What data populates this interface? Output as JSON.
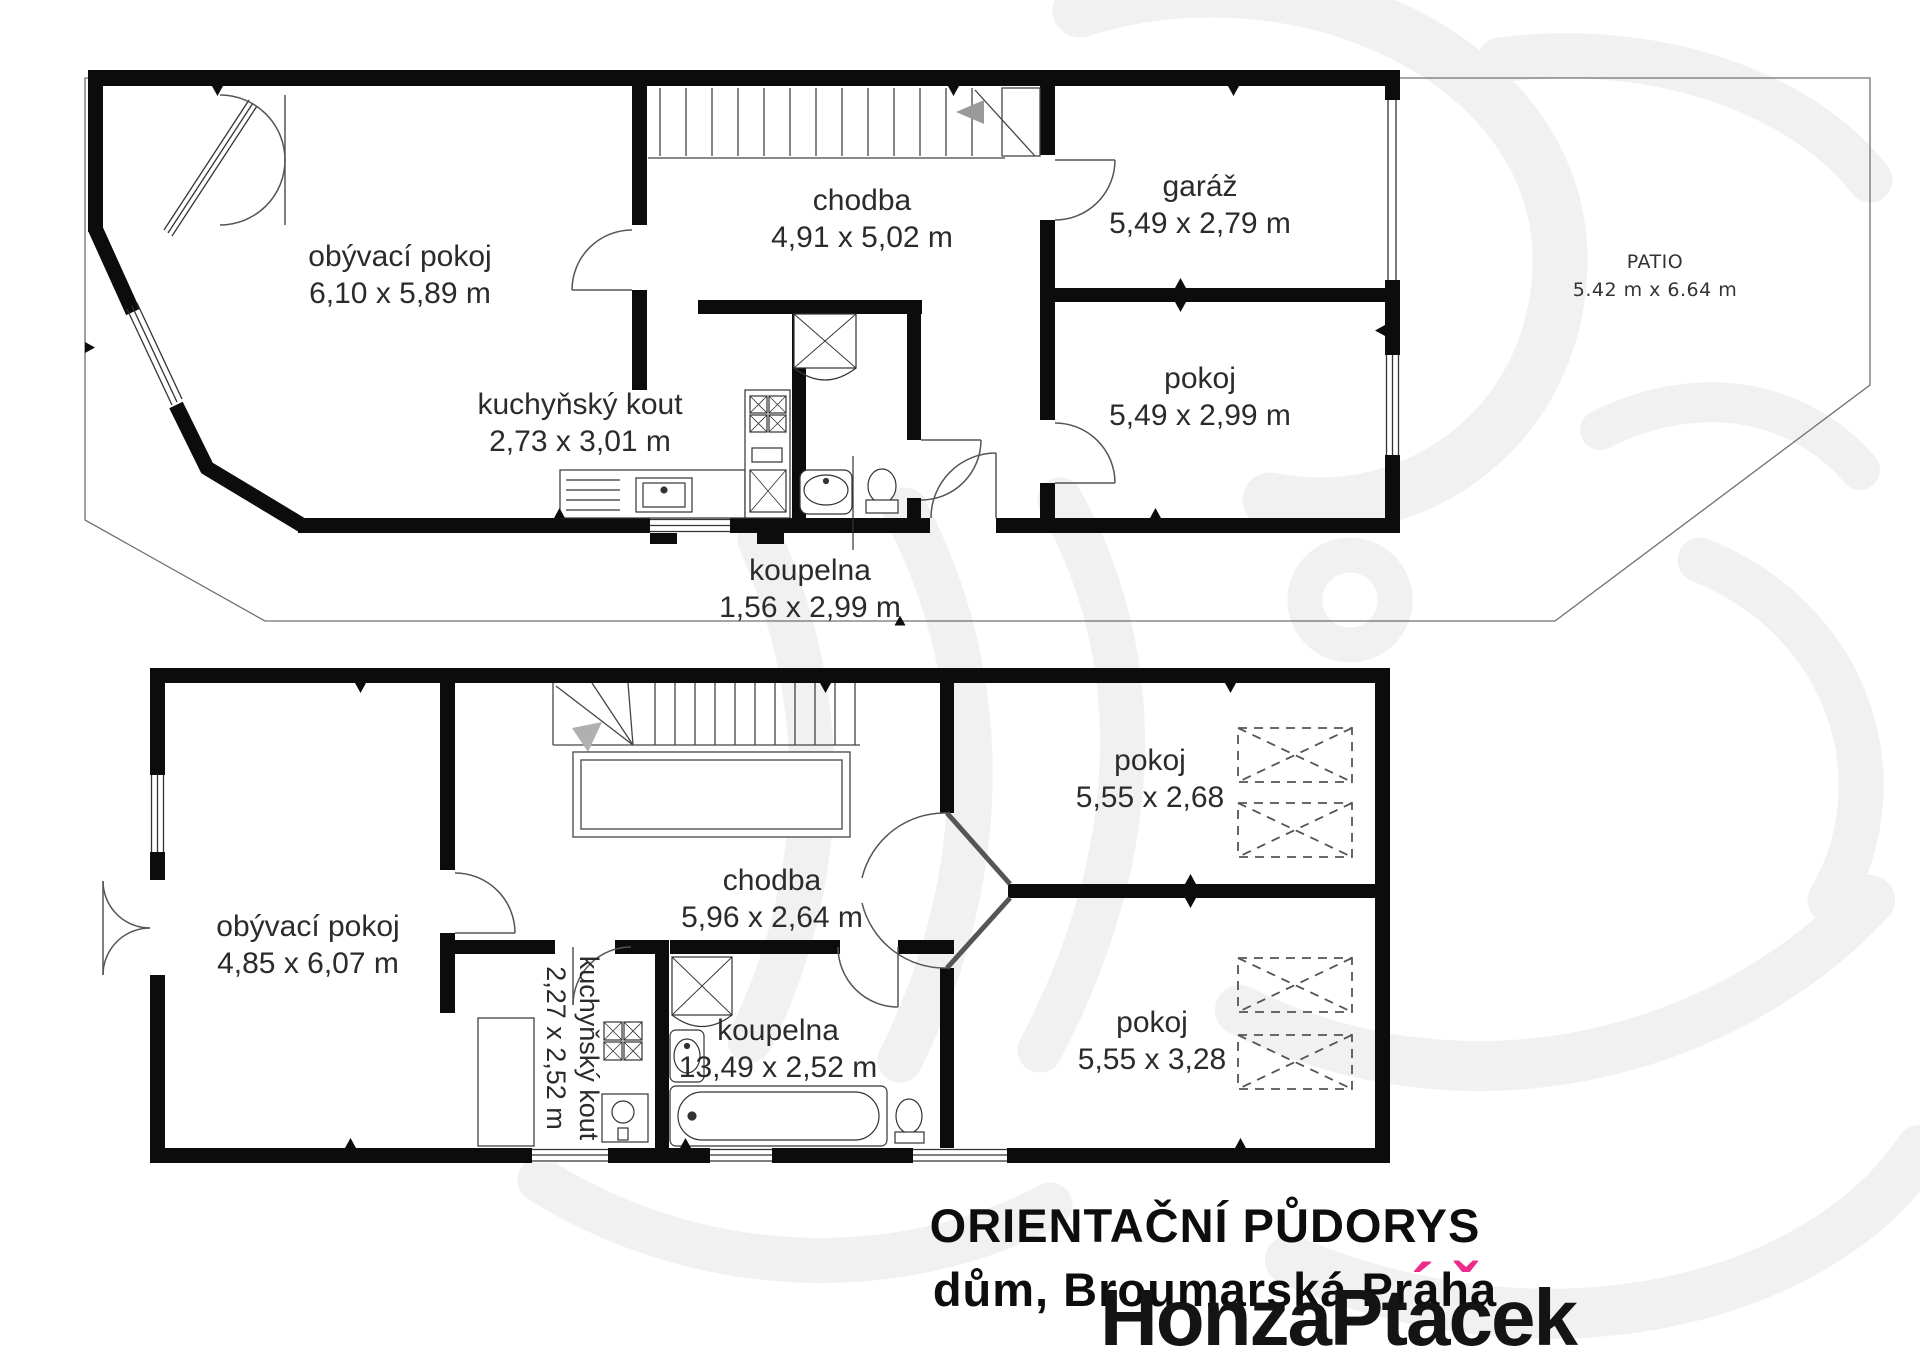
{
  "plans": {
    "top": {
      "rooms": {
        "living": {
          "name": "obývací pokoj",
          "dims": "6,10 x 5,89 m"
        },
        "kitchen": {
          "name": "kuchyňský kout",
          "dims": "2,73 x 3,01 m"
        },
        "hall": {
          "name": "chodba",
          "dims": "4,91 x 5,02 m"
        },
        "garage": {
          "name": "garáž",
          "dims": "5,49 x 2,79 m"
        },
        "room": {
          "name": "pokoj",
          "dims": "5,49 x 2,99 m"
        },
        "bathroom": {
          "name": "koupelna",
          "dims": "1,56 x 2,99 m"
        },
        "patio": {
          "name": "PATIO",
          "dims": "5.42 m x 6.64 m"
        }
      }
    },
    "bottom": {
      "rooms": {
        "living": {
          "name": "obývací pokoj",
          "dims": "4,85 x 6,07 m"
        },
        "hall": {
          "name": "chodba",
          "dims": "5,96 x 2,64 m"
        },
        "kitchen": {
          "name": "kuchyňský kout",
          "dims": "2,27 x 2,52 m"
        },
        "bathroom": {
          "name": "koupelna",
          "dims": "13,49 x 2,52 m"
        },
        "room1": {
          "name": "pokoj",
          "dims": "5,55 x 2,68"
        },
        "room2": {
          "name": "pokoj",
          "dims": "5,55 x 3,28"
        }
      }
    }
  },
  "title": {
    "line1": "ORIENTAČNÍ PŮDORYS",
    "line2": "dům, Broumarská Praha"
  },
  "watermark": {
    "text": "HonzaPtáček",
    "part1": "HonzaPt",
    "a_base": "a",
    "c_base": "c",
    "part3": "ek",
    "acute": "´",
    "caron": "ˇ",
    "accent_color": "#ec2c8d"
  },
  "colors": {
    "wall": "#0c0c0c",
    "thin_line": "#444444",
    "boundary": "#707070",
    "logo_tint": "#f1f1f1",
    "stair_arrow": "#9a9a9a"
  }
}
